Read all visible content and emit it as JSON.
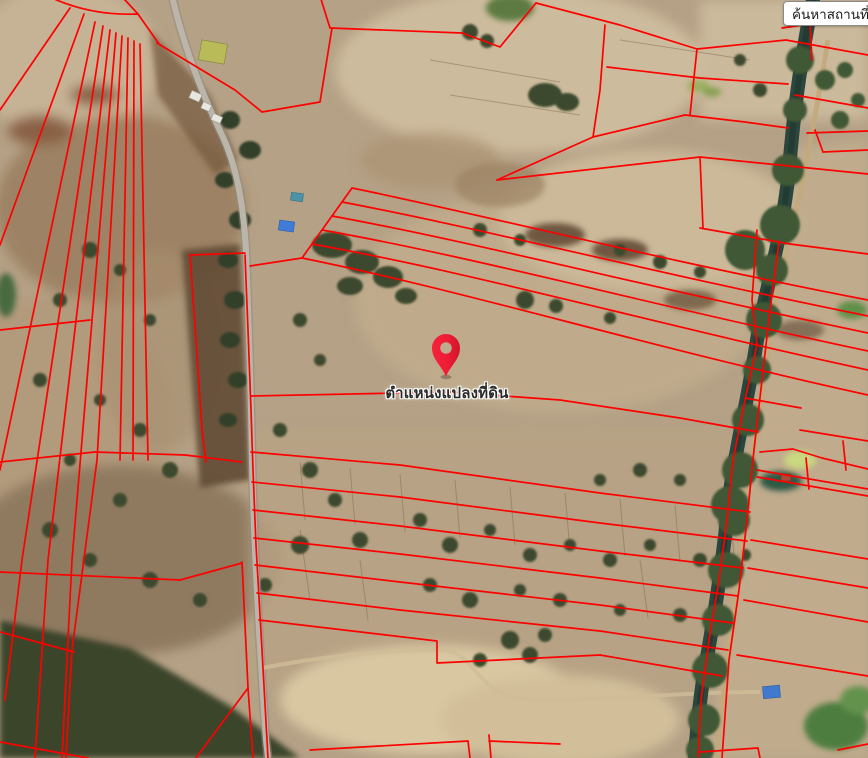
{
  "search": {
    "placeholder": "ค้นหาสถานที่"
  },
  "map": {
    "marker_label": "ตำแหน่งแปลงที่ดิน",
    "colors": {
      "parcel_line": "#fe0000",
      "pin_red": "#ee1c34",
      "pin_red_dark": "#cf142c",
      "terrain_base": "#b5a186",
      "river_water": "#2b463c",
      "forest_green": "#3a452c",
      "road_gray": "#bcb6aa"
    }
  }
}
